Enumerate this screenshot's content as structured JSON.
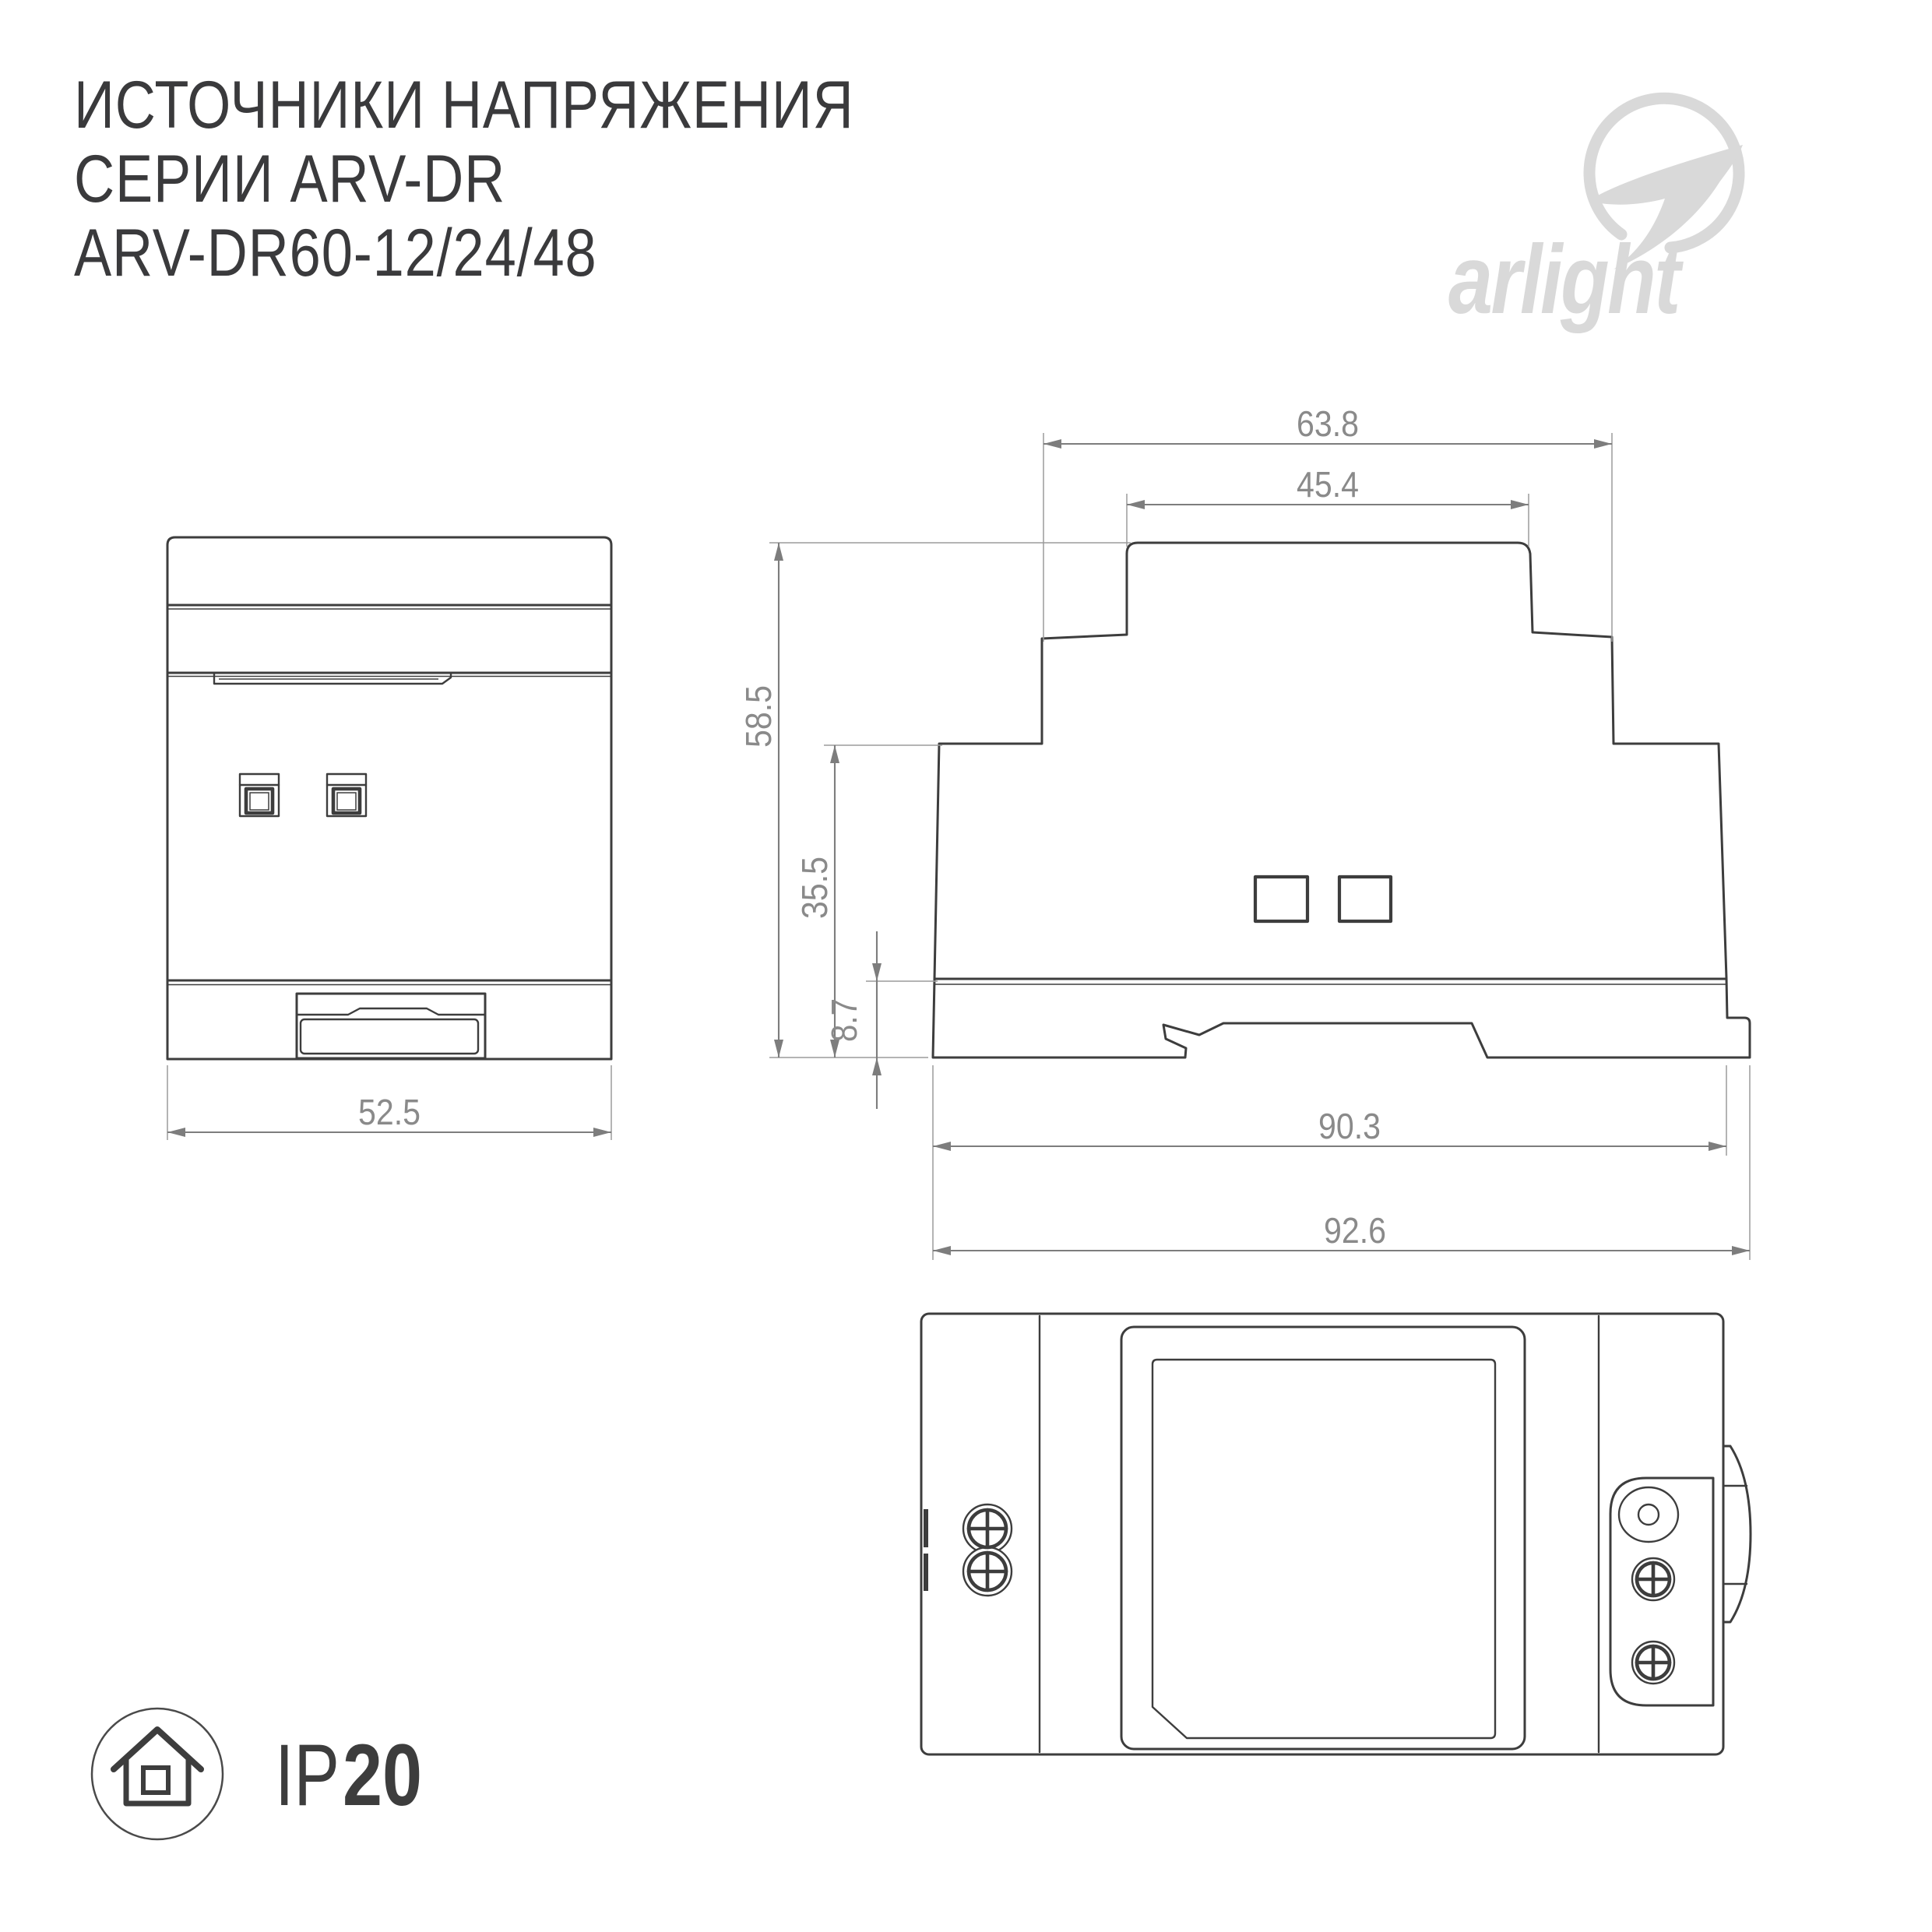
{
  "title": {
    "line1": "ИСТОЧНИКИ НАПРЯЖЕНИЯ",
    "line2": "СЕРИИ ARV-DR",
    "line3": "ARV-DR60-12/24/48"
  },
  "logo": {
    "wordmark": "arlight"
  },
  "dims": {
    "front": {
      "width": "52.5"
    },
    "side": {
      "top_width": "63.8",
      "shoulder_width": "45.4",
      "height": "58.5",
      "body_height": "35.5",
      "foot_height": "8.7",
      "body_width": "90.3",
      "overall_width": "92.6"
    }
  },
  "footer": {
    "ip_prefix": "IP",
    "ip_value": "20"
  },
  "icons": {
    "brand": "arlight-swoosh-icon",
    "protection": "house-in-circle-icon"
  },
  "colors": {
    "ink": "#3d3d3d",
    "dimension_lines": "#7d7d7d",
    "dimension_text": "#8a8a8a",
    "logo": "#d9d9d9",
    "title_text": "#3a3a3c",
    "background": "#ffffff"
  }
}
